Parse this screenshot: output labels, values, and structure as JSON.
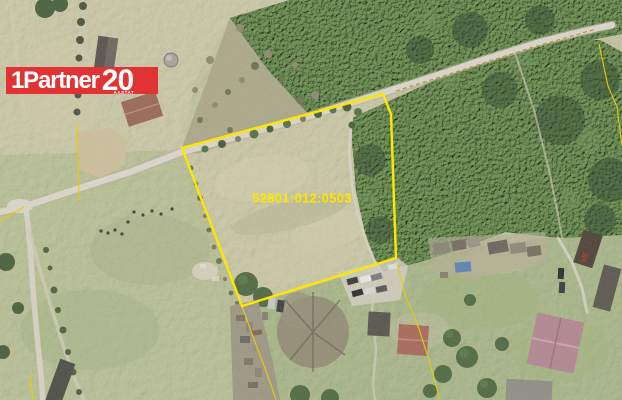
{
  "logo": {
    "brand": "1Partner",
    "anniversary_number": "20",
    "anniversary_caption": "AASTAT",
    "background_color": "#E13334",
    "text_color": "#FFFFFF"
  },
  "parcel": {
    "cadastral_number": "52801:012:0503",
    "label_color": "#FFE600",
    "label_position": {
      "x": 302,
      "y": 198
    },
    "boundary_color": "#FFE600",
    "boundary_points": [
      [
        182,
        148
      ],
      [
        383,
        94
      ],
      [
        391,
        114
      ],
      [
        396,
        258
      ],
      [
        242,
        306
      ]
    ]
  },
  "map": {
    "type": "aerial-photo",
    "minor_line_color": "#E3CF00",
    "boundary_lines": [
      {
        "name": "cadastral-line-southwest",
        "points": [
          [
            242,
            306
          ],
          [
            252,
            334
          ],
          [
            263,
            363
          ],
          [
            271,
            385
          ],
          [
            276,
            400
          ]
        ]
      },
      {
        "name": "cadastral-line-southeast",
        "points": [
          [
            397,
            264
          ],
          [
            406,
            297
          ],
          [
            419,
            329
          ],
          [
            428,
            357
          ],
          [
            436,
            385
          ],
          [
            440,
            400
          ]
        ]
      },
      {
        "name": "cadastral-line-west",
        "points": [
          [
            77,
            124
          ],
          [
            78,
            162
          ],
          [
            79,
            200
          ]
        ]
      },
      {
        "name": "cadastral-line-road-left",
        "points": [
          [
            0,
            221
          ],
          [
            24,
            207
          ]
        ]
      },
      {
        "name": "cadastral-line-bottom-left",
        "points": [
          [
            30,
            376
          ],
          [
            33,
            400
          ]
        ]
      },
      {
        "name": "cadastral-line-northeast",
        "points": [
          [
            396,
            91
          ],
          [
            462,
            70
          ],
          [
            530,
            48
          ],
          [
            596,
            29
          ]
        ],
        "dashed": true,
        "color": "#C2882C"
      },
      {
        "name": "cadastral-line-east",
        "points": [
          [
            599,
            44
          ],
          [
            608,
            86
          ],
          [
            617,
            107
          ],
          [
            622,
            146
          ]
        ]
      }
    ]
  }
}
